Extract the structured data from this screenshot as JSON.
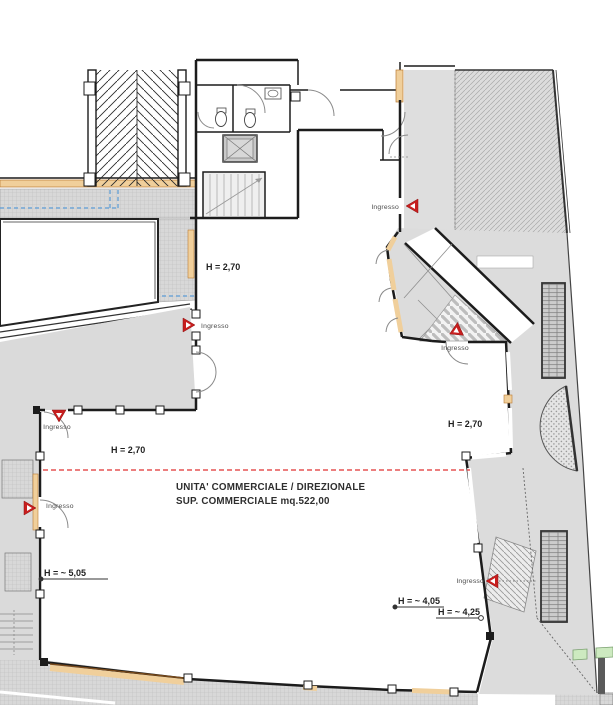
{
  "plan": {
    "title_line1": "UNITA' COMMERCIALE / DIREZIONALE",
    "title_line2": "SUP. COMMERCIALE mq.522,00",
    "entrance_label": "Ingresso",
    "heights": {
      "h270": "H = 2,70",
      "h505": "H = ~ 5,05",
      "h405": "H = ~ 4,05",
      "h425": "H = ~ 4,25"
    },
    "colors": {
      "marker_red": "#c81e1e",
      "zone_boundary_dashed_red": "#e03030",
      "utility_dashed_blue": "#5b9bd5",
      "window_tan": "#f0cf9b",
      "paving_gray": "#d9d9d9",
      "hedge_green": "#cdeac0"
    }
  }
}
